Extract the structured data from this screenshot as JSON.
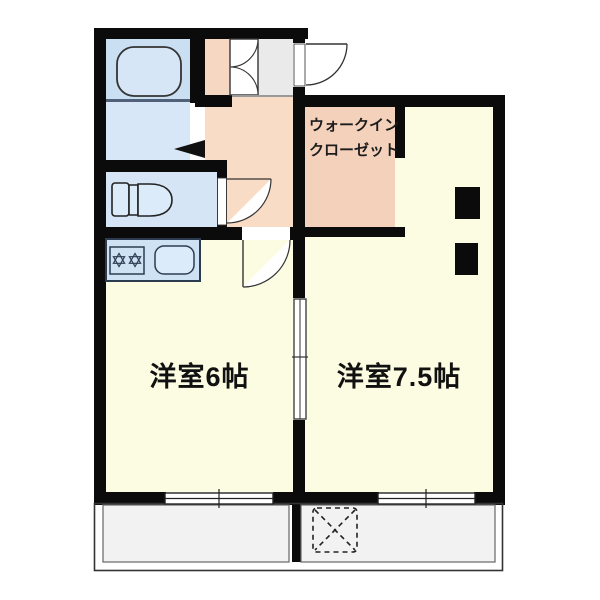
{
  "plan": {
    "type": "japanese-apartment-floor-plan",
    "rooms": {
      "western_room_left": {
        "label": "洋室6帖"
      },
      "western_room_right": {
        "label": "洋室7.5帖"
      },
      "walk_in_closet": {
        "label_line1": "ウォークイン",
        "label_line2": "クローゼット"
      }
    },
    "fixtures": [
      "bathtub-icon",
      "washroom-folding-door-icon",
      "toilet-icon",
      "toilet-door-icon",
      "kitchen-counter-icon",
      "stove-burners-icon",
      "kitchen-sink-icon",
      "entry-door-icon",
      "entry-closet-double-door-icon",
      "room-door-icon",
      "sliding-door-icon",
      "sliding-window-icon",
      "balcony",
      "balcony-divider",
      "washing-machine-pad-icon",
      "pillar"
    ],
    "colors": {
      "wall": "#0b0b0b",
      "room_yellow": "#fcfce2",
      "bathroom_blue": "#cbdff3",
      "washroom_blue": "#d8e7f8",
      "toilet_blue": "#d5e5f6",
      "kitchen_counter_blue": "#cfe2f4",
      "hallway_salmon": "#f8dcc6",
      "closet_salmon": "#f4d1bb",
      "storage_salmon": "#f6d8c2",
      "entrance_gray": "#eaeaea",
      "balcony_gray": "#f2f2f2",
      "outline": "#333333"
    }
  }
}
